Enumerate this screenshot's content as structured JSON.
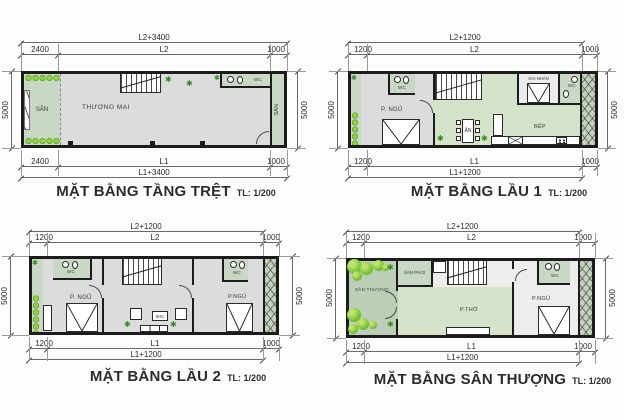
{
  "colors": {
    "wall": "#1c1c1c",
    "floor_gray": "#dcdcdd",
    "floor_light": "#ededed",
    "green_sage": "#c9d8c4",
    "green_pastel": "#d4e3c9",
    "green_terrace": "#bccfb6",
    "foliage": "#6cbf2e",
    "dim_line": "#6a6a6a",
    "text": "#2f2f2f"
  },
  "plans": [
    {
      "id": "tang-tret",
      "title": "MẶT BẰNG TẦNG TRỆT",
      "scale": "TL: 1/200",
      "dims": {
        "top_overall": "L2+3400",
        "top_a": "2400",
        "top_b": "L2",
        "top_c": "1000",
        "left": "5000",
        "right": "5000",
        "bottom_a": "2400",
        "bottom_b": "L1",
        "bottom_c": "1000",
        "bottom_overall": "L1+3400"
      },
      "rooms": {
        "san_left": "SÂN",
        "thuong_mai": "THƯƠNG MẠI",
        "wc": "WC",
        "san_right": "SÂN"
      }
    },
    {
      "id": "lau-1",
      "title": "MẶT BẰNG LẦU 1",
      "scale": "TL: 1/200",
      "dims": {
        "top_overall": "L2+1200",
        "top_a": "1200",
        "top_b": "L2",
        "top_c": "1000",
        "left": "5000",
        "right": "5000",
        "bottom_a": "1200",
        "bottom_b": "L1",
        "bottom_c": "1000",
        "bottom_overall": "L1+1200"
      },
      "rooms": {
        "wc_left": "WC",
        "p_ngu": "P. NGỦ",
        "an": "ĂN",
        "gia_nhan": "GIA NHÂN",
        "wc_right": "WC",
        "bep": "BẾP"
      }
    },
    {
      "id": "lau-2",
      "title": "MẶT BẰNG LẦU 2",
      "scale": "TL: 1/200",
      "dims": {
        "top_overall": "L2+1200",
        "top_a": "1200",
        "top_b": "L2",
        "top_c": "1000",
        "left": "5000",
        "right": "5000",
        "bottom_a": "1200",
        "bottom_b": "L1",
        "bottom_c": "1000",
        "bottom_overall": "L1+1200"
      },
      "rooms": {
        "wc_left": "WC",
        "p_ngu_left": "P. NGỦ",
        "shc": "SHC",
        "wc_right": "WC",
        "p_ngu_right": "P.NGỦ"
      }
    },
    {
      "id": "san-thuong",
      "title": "MẶT BẰNG SÂN THƯỢNG",
      "scale": "TL: 1/200",
      "dims": {
        "top_overall": "L2+1200",
        "top_a": "1200",
        "top_b": "L2",
        "top_c": "1000",
        "left": "5000",
        "right": "5000",
        "bottom_a": "1200",
        "bottom_b": "L1",
        "bottom_c": "1000",
        "bottom_overall": "L1+1200"
      },
      "rooms": {
        "san_thuong": "SÂN THƯỢNG",
        "san_phoi": "SÂN PHƠI",
        "p_tho": "P.THỜ",
        "wc": "WC",
        "p_ngu": "P.NGỦ"
      }
    }
  ]
}
